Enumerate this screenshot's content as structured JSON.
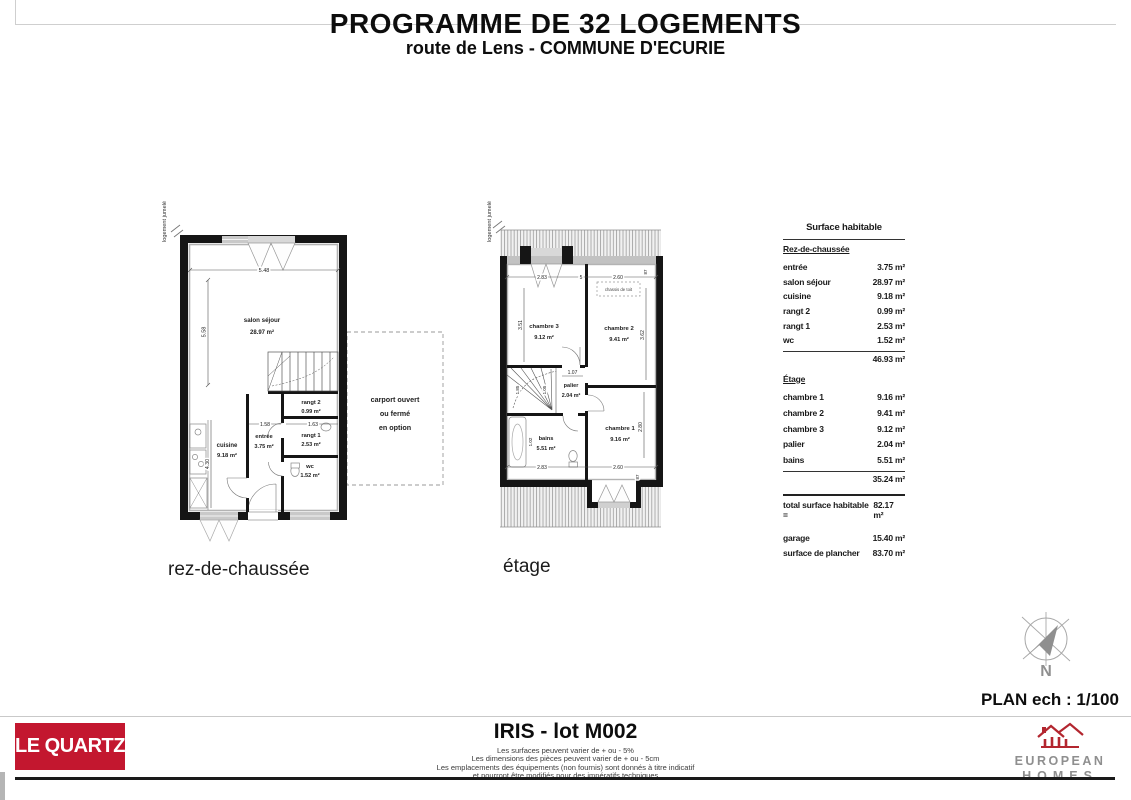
{
  "header": {
    "title": "PROGRAMME DE 32 LOGEMENTS",
    "subtitle": "route de Lens - COMMUNE D'ECURIE"
  },
  "plans": {
    "rdc": {
      "caption": "rez-de-chaussée",
      "jumele": "logement jumelé",
      "salon": {
        "name": "salon séjour",
        "area": "28.97 m²"
      },
      "cuisine": {
        "name": "cuisine",
        "area": "9.18 m²"
      },
      "entree": {
        "name": "entrée",
        "area": "3.75 m²"
      },
      "rangt2": {
        "name": "rangt 2",
        "area": "0.99 m²"
      },
      "rangt1": {
        "name": "rangt 1",
        "area": "2.53 m²"
      },
      "wc": {
        "name": "wc",
        "area": "1.52 m²"
      },
      "dims": {
        "top_width": "5.48",
        "left_height": "5.58",
        "cuisine_height": "4.30",
        "entree_width": "1.58",
        "rangt_width": "1.63"
      },
      "carport": {
        "line1": "carport ouvert",
        "line2": "ou fermé",
        "line3": "en option"
      }
    },
    "etage": {
      "caption": "étage",
      "jumele": "logement jumelé",
      "chambre3": {
        "name": "chambre 3",
        "area": "9.12 m²"
      },
      "chambre2": {
        "name": "chambre 2",
        "area": "9.41 m²"
      },
      "chambre1": {
        "name": "chambre 1",
        "area": "9.16 m²"
      },
      "palier": {
        "name": "palier",
        "area": "2.04 m²"
      },
      "bains": {
        "name": "bains",
        "area": "5.51 m²"
      },
      "chassis": "chassis de toit",
      "dims": {
        "top_left": "2.83",
        "top_mid": "5",
        "top_right": "2.60",
        "top_edge": "87",
        "ch3_height": "3.51",
        "ch2_height": "3.62",
        "palier_width": "1.07",
        "stair_w1": "1.85",
        "stair_w2": "1.05",
        "bain_width": "1.02",
        "ch1_height": "2.80",
        "bottom_left": "2.83",
        "bottom_right": "2.60",
        "bottom_edge": "87"
      }
    }
  },
  "surface_table": {
    "title": "Surface habitable",
    "rdc_heading": "Rez-de-chaussée",
    "rdc_rows": [
      {
        "label": "entrée",
        "value": "3.75 m²"
      },
      {
        "label": "salon séjour",
        "value": "28.97 m²"
      },
      {
        "label": "cuisine",
        "value": "9.18 m²"
      },
      {
        "label": "rangt 2",
        "value": "0.99 m²"
      },
      {
        "label": "rangt 1",
        "value": "2.53 m²"
      },
      {
        "label": "wc",
        "value": "1.52 m²"
      }
    ],
    "rdc_subtotal": "46.93 m²",
    "etage_heading": "Étage",
    "etage_rows": [
      {
        "label": "chambre 1",
        "value": "9.16 m²"
      },
      {
        "label": "chambre 2",
        "value": "9.41 m²"
      },
      {
        "label": "chambre 3",
        "value": "9.12 m²"
      },
      {
        "label": "palier",
        "value": "2.04 m²"
      },
      {
        "label": "bains",
        "value": "5.51 m²"
      }
    ],
    "etage_subtotal": "35.24 m²",
    "total_label": "total surface habitable =",
    "total_value": "82.17 m²",
    "garage_label": "garage",
    "garage_value": "15.40 m²",
    "plancher_label": "surface de plancher",
    "plancher_value": "83.70 m²"
  },
  "compass": {
    "north": "N"
  },
  "scale_label": "PLAN ech : 1/100",
  "footer": {
    "brand": "LE QUARTZ",
    "lot": "IRIS - lot M002",
    "disclaimer1": "Les surfaces peuvent varier de + ou - 5%",
    "disclaimer2": "Les dimensions des pièces peuvent varier de + ou - 5cm",
    "disclaimer3": "Les emplacements des équipements (non fournis) sont donnés à titre indicatif",
    "disclaimer4": "et pourront être modifiés pour des impératifs techniques",
    "logo_line1": "EUROPEAN",
    "logo_line2": "HOMES"
  },
  "colors": {
    "brand_red": "#c3172f",
    "logo_red": "#b3262f",
    "logo_gray": "#8f8f8f"
  }
}
